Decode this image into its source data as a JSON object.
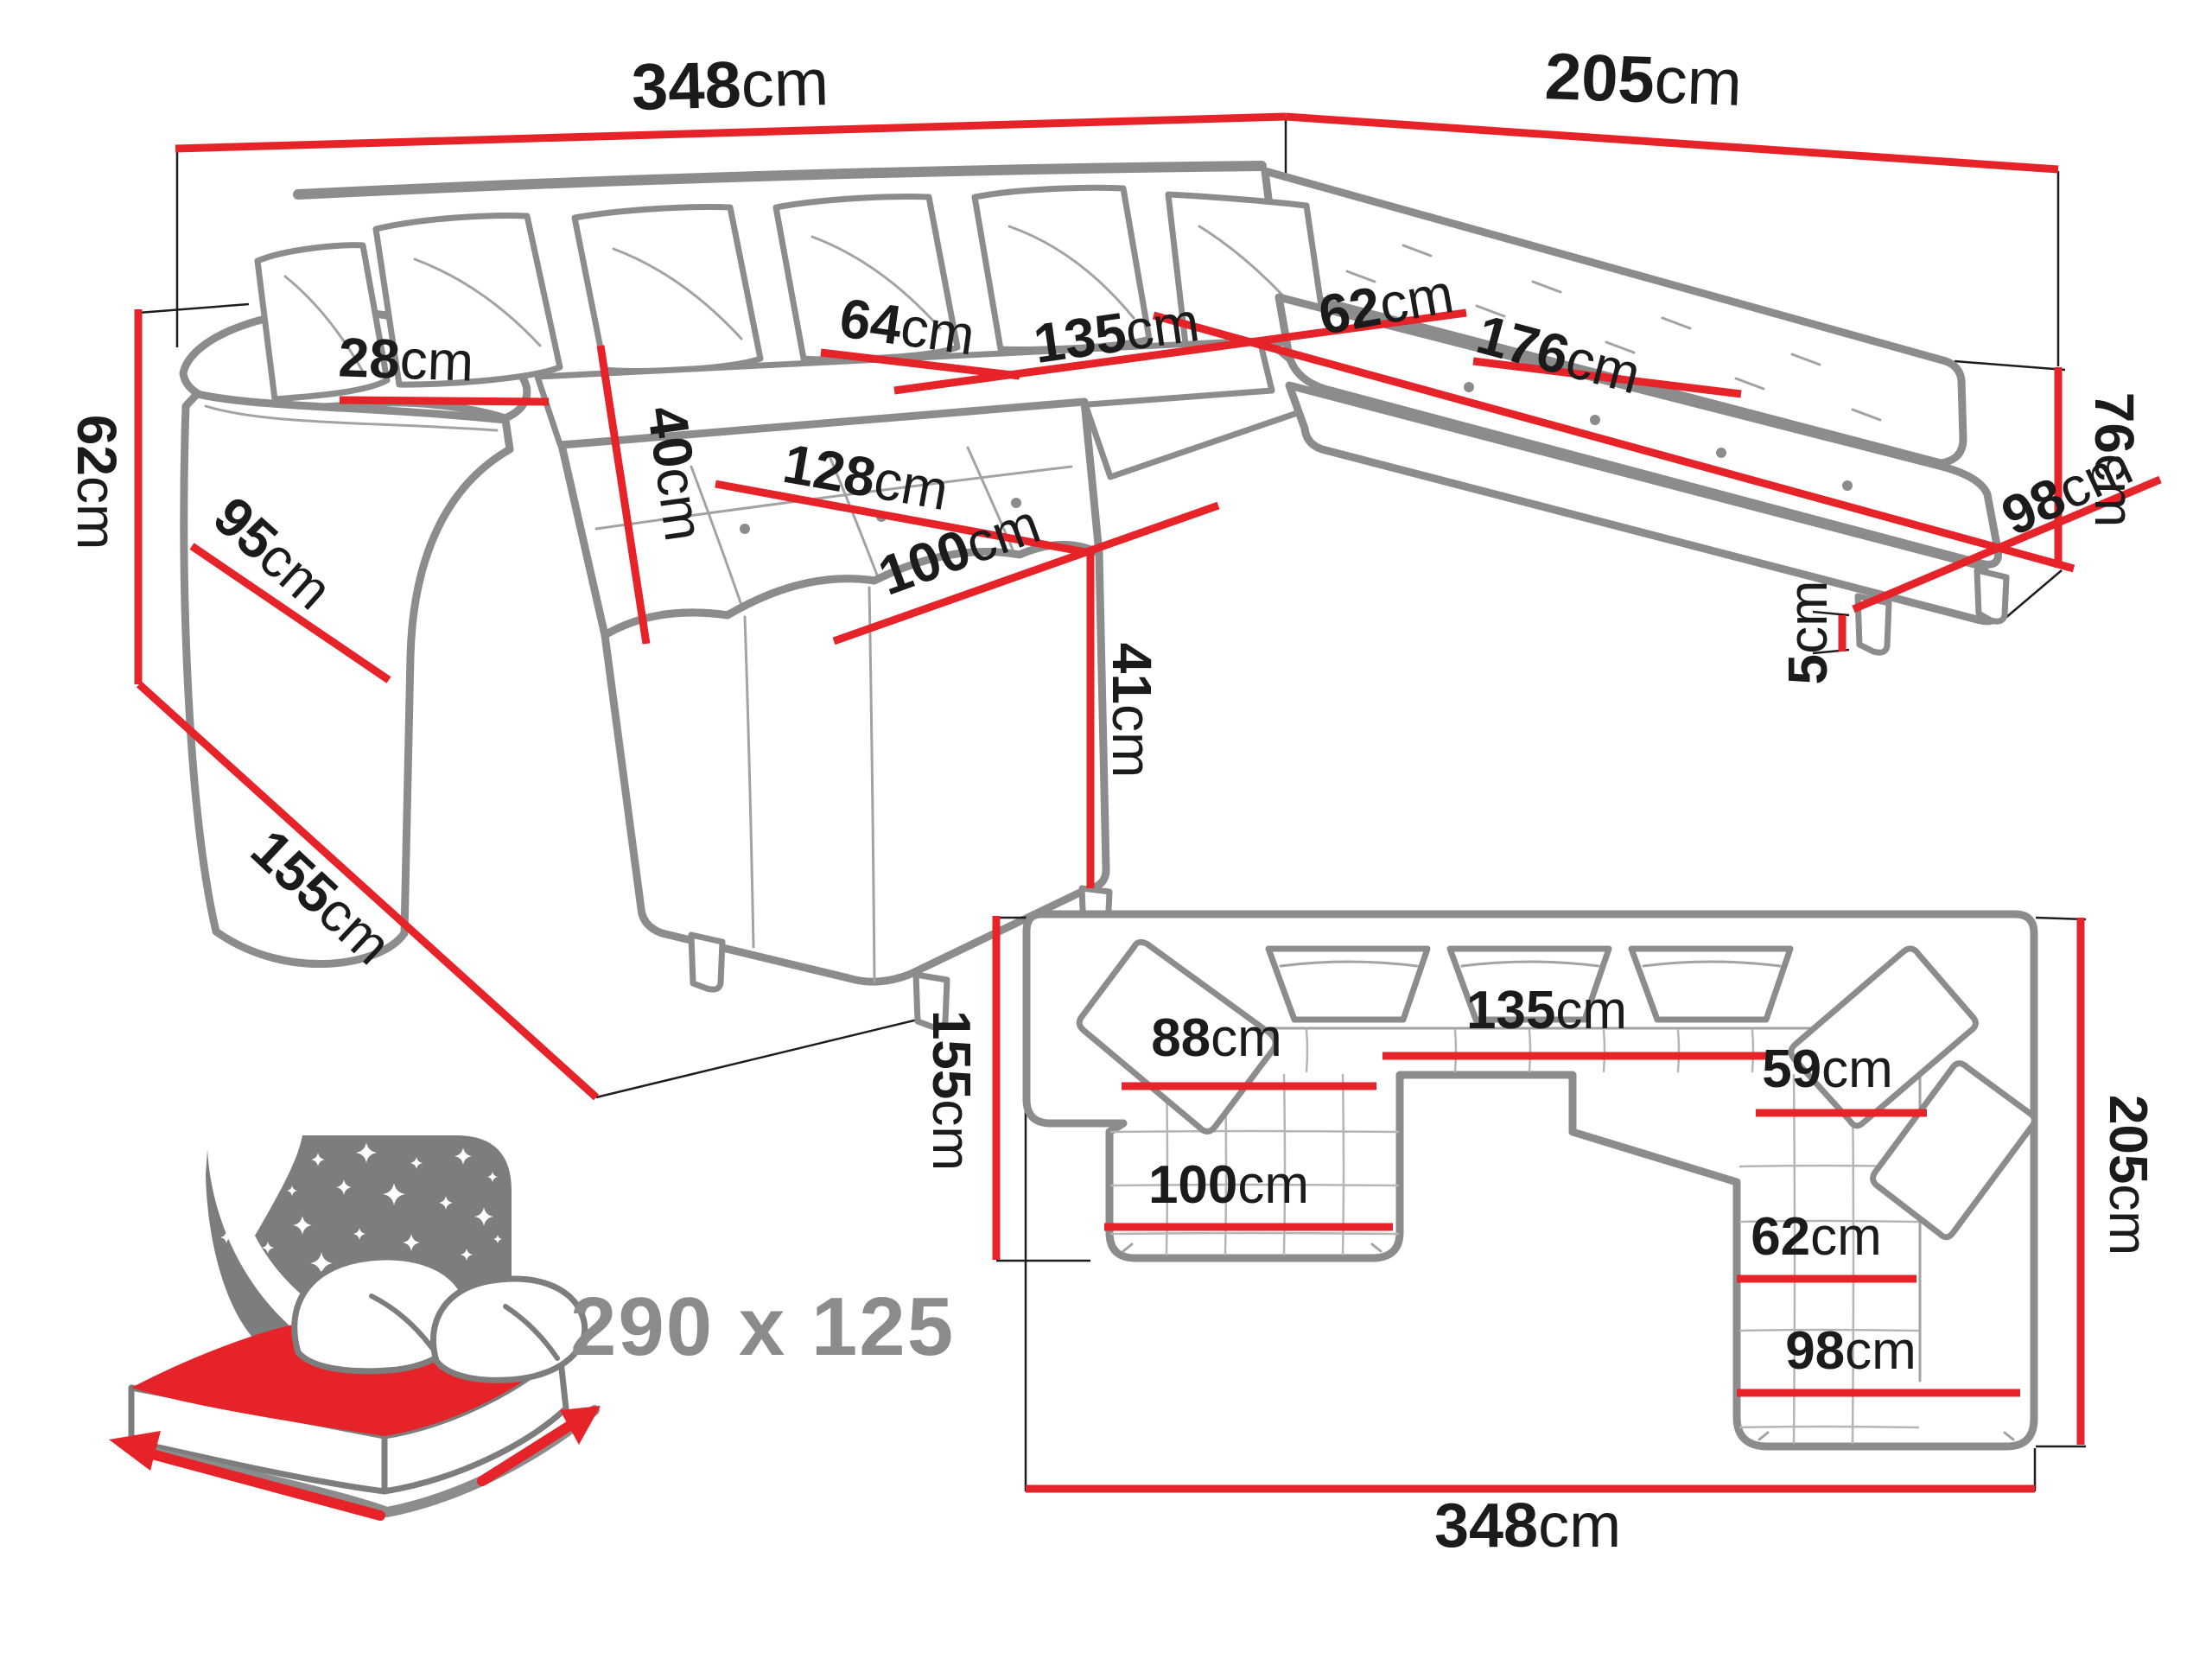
{
  "colors": {
    "accent": "#e62329",
    "outline": "#8c8c8c",
    "ink": "#1b1b1b",
    "muted": "#8b8b8b"
  },
  "perspective": {
    "dims": [
      {
        "id": "back-width",
        "num": "348",
        "unit": "cm"
      },
      {
        "id": "right-width",
        "num": "205",
        "unit": "cm"
      },
      {
        "id": "backrest-height",
        "num": "76",
        "unit": "cm"
      },
      {
        "id": "armrest-height",
        "num": "62",
        "unit": "cm"
      },
      {
        "id": "armrest-side",
        "num": "95",
        "unit": "cm"
      },
      {
        "id": "chaise-floor-depth",
        "num": "155",
        "unit": "cm"
      },
      {
        "id": "armrest-top-width",
        "num": "28",
        "unit": "cm"
      },
      {
        "id": "back-cushion",
        "num": "40",
        "unit": "cm"
      },
      {
        "id": "seat-depth-left",
        "num": "64",
        "unit": "cm"
      },
      {
        "id": "seat-width-middle",
        "num": "135",
        "unit": "cm"
      },
      {
        "id": "chaise-length",
        "num": "128",
        "unit": "cm"
      },
      {
        "id": "seat-depth-corner",
        "num": "62",
        "unit": "cm"
      },
      {
        "id": "seat-width-right",
        "num": "176",
        "unit": "cm"
      },
      {
        "id": "seat-front-right",
        "num": "98",
        "unit": "cm"
      },
      {
        "id": "chaise-width",
        "num": "100",
        "unit": "cm"
      },
      {
        "id": "seat-height",
        "num": "41",
        "unit": "cm"
      },
      {
        "id": "leg-height",
        "num": "5",
        "unit": "cm"
      }
    ]
  },
  "plan": {
    "dims": [
      {
        "id": "plan-depth-left",
        "num": "155",
        "unit": "cm"
      },
      {
        "id": "plan-seat-left",
        "num": "88",
        "unit": "cm"
      },
      {
        "id": "plan-seat-middle",
        "num": "135",
        "unit": "cm"
      },
      {
        "id": "plan-seat-corner",
        "num": "59",
        "unit": "cm"
      },
      {
        "id": "plan-chaise-width",
        "num": "100",
        "unit": "cm"
      },
      {
        "id": "plan-seat-right",
        "num": "62",
        "unit": "cm"
      },
      {
        "id": "plan-front-right",
        "num": "98",
        "unit": "cm"
      },
      {
        "id": "plan-depth-right",
        "num": "205",
        "unit": "cm"
      },
      {
        "id": "plan-total-width",
        "num": "348",
        "unit": "cm"
      }
    ]
  },
  "sleeping_area": {
    "label": "290 x 125"
  }
}
